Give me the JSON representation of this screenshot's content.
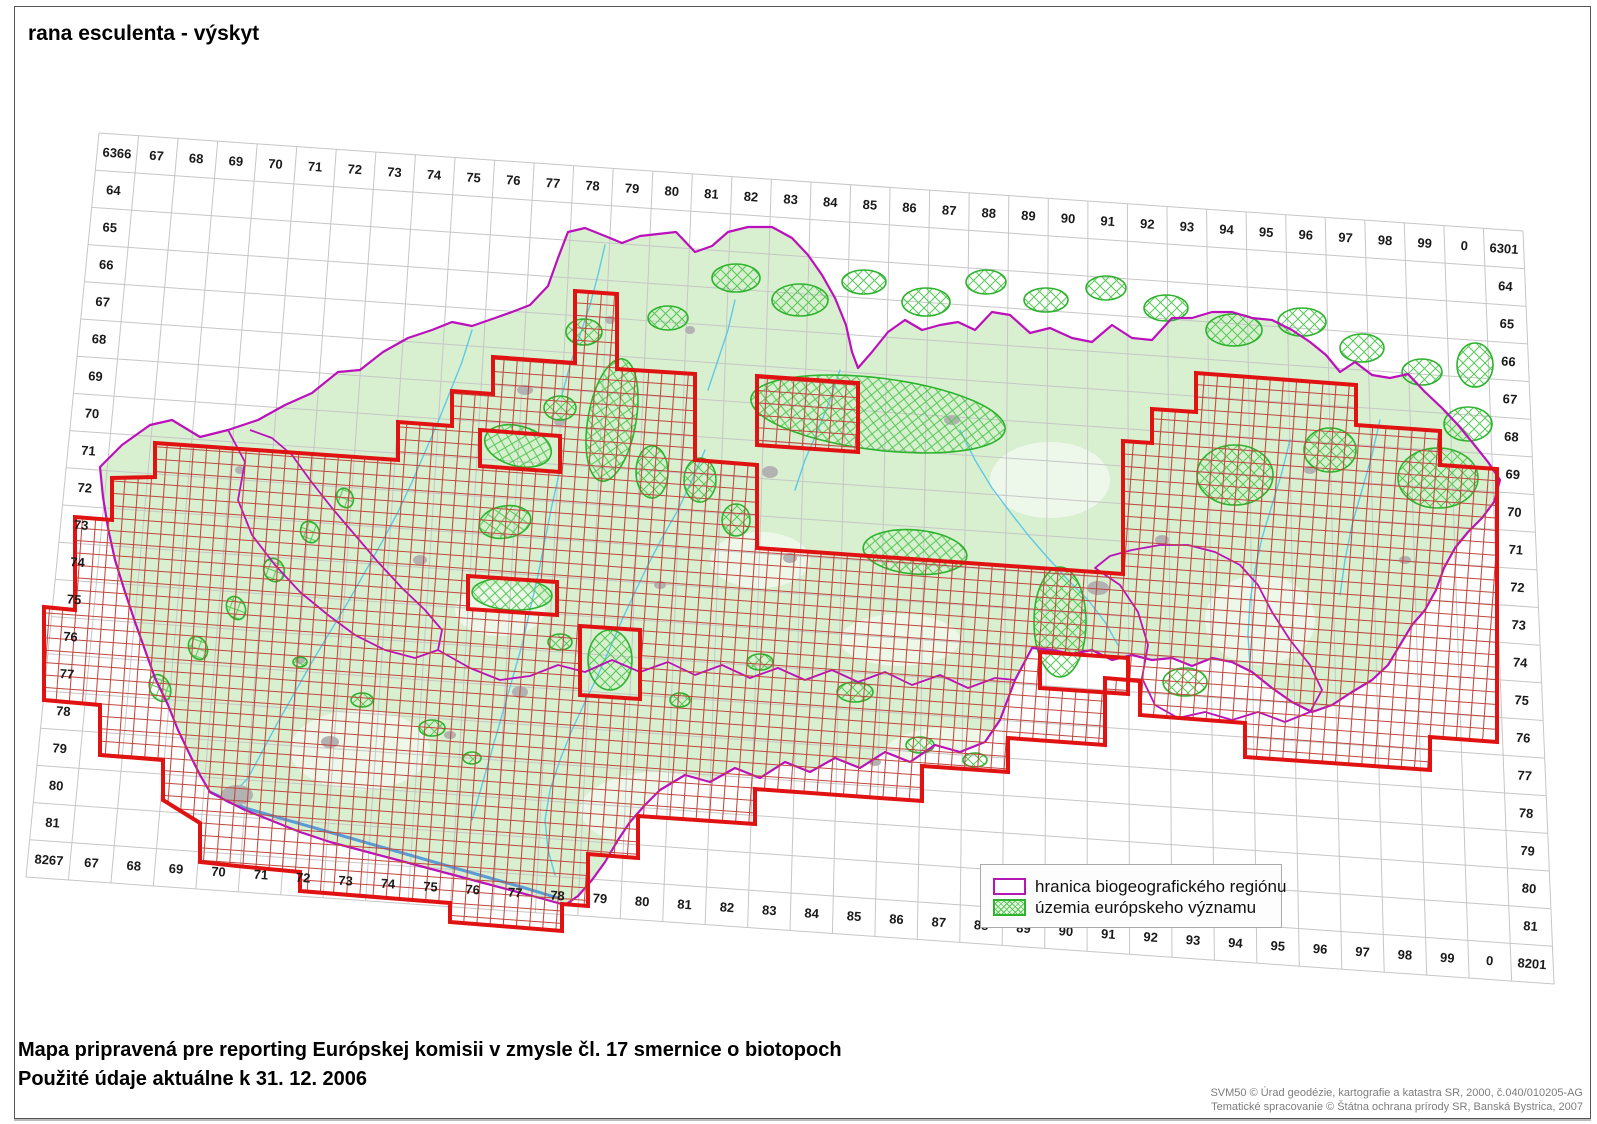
{
  "page": {
    "title": "rana esculenta - výskyt"
  },
  "grid": {
    "corner_labels": {
      "top_left": "6366",
      "top_right": "6301",
      "bottom_left": "8267",
      "bottom_right": "8201"
    },
    "column_labels": [
      "67",
      "68",
      "69",
      "70",
      "71",
      "72",
      "73",
      "74",
      "75",
      "76",
      "77",
      "78",
      "79",
      "80",
      "81",
      "82",
      "83",
      "84",
      "85",
      "86",
      "87",
      "88",
      "89",
      "90",
      "91",
      "92",
      "93",
      "94",
      "95",
      "96",
      "97",
      "98",
      "99",
      "0"
    ],
    "row_labels": [
      "64",
      "65",
      "66",
      "67",
      "68",
      "69",
      "70",
      "71",
      "72",
      "73",
      "74",
      "75",
      "76",
      "77",
      "78",
      "79",
      "80",
      "81"
    ]
  },
  "legend": {
    "items": [
      {
        "swatch": "purple-outline-box",
        "label": "hranica biogeografického regiónu"
      },
      {
        "swatch": "green-crosshatch-box",
        "label": "územia európskeho významu"
      }
    ]
  },
  "footer": {
    "line1": "Mapa pripravená pre reporting Európskej komisii v zmysle čl. 17 smernice o biotopoch",
    "line2": "Použité údaje aktuálne k 31. 12. 2006"
  },
  "credits": {
    "line1": "SVM50 © Úrad geodézie, kartografie a katastra SR, 2000, č.040/010205-AG",
    "line2": "Tematické spracovanie © Štátna ochrana prírody SR, Banská Bystrica, 2007"
  },
  "colors": {
    "occurrence_grid": "#c0463c",
    "occurrence_outline": "#e01212",
    "biogeographic_boundary": "#bb10bb",
    "sci_area_green": "#2db32d",
    "terrain_green": "#d8f0d0",
    "water_blue": "#5fc8e6",
    "base_grid_gray": "#c6c6c6"
  }
}
